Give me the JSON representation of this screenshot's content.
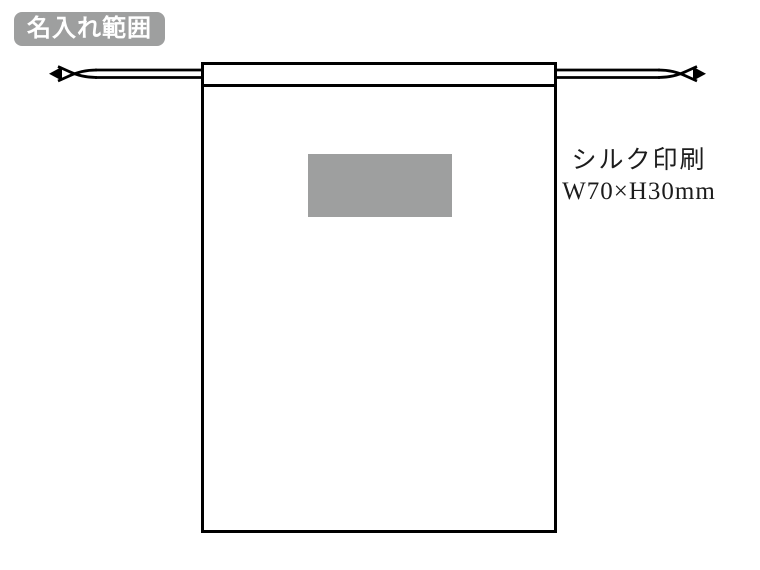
{
  "badge": {
    "label": "名入れ範囲"
  },
  "diagram": {
    "item": "drawstring-pouch",
    "annotation": {
      "method": "シルク印刷",
      "size": "W70×H30mm"
    }
  },
  "colors": {
    "page_bg": "#ffffff",
    "badge_bg": "#9e9f9f",
    "badge_text": "#ffffff",
    "print_area_fill": "#9e9f9f",
    "line_color": "#000000",
    "annotation_text": "#1c1c1c"
  }
}
